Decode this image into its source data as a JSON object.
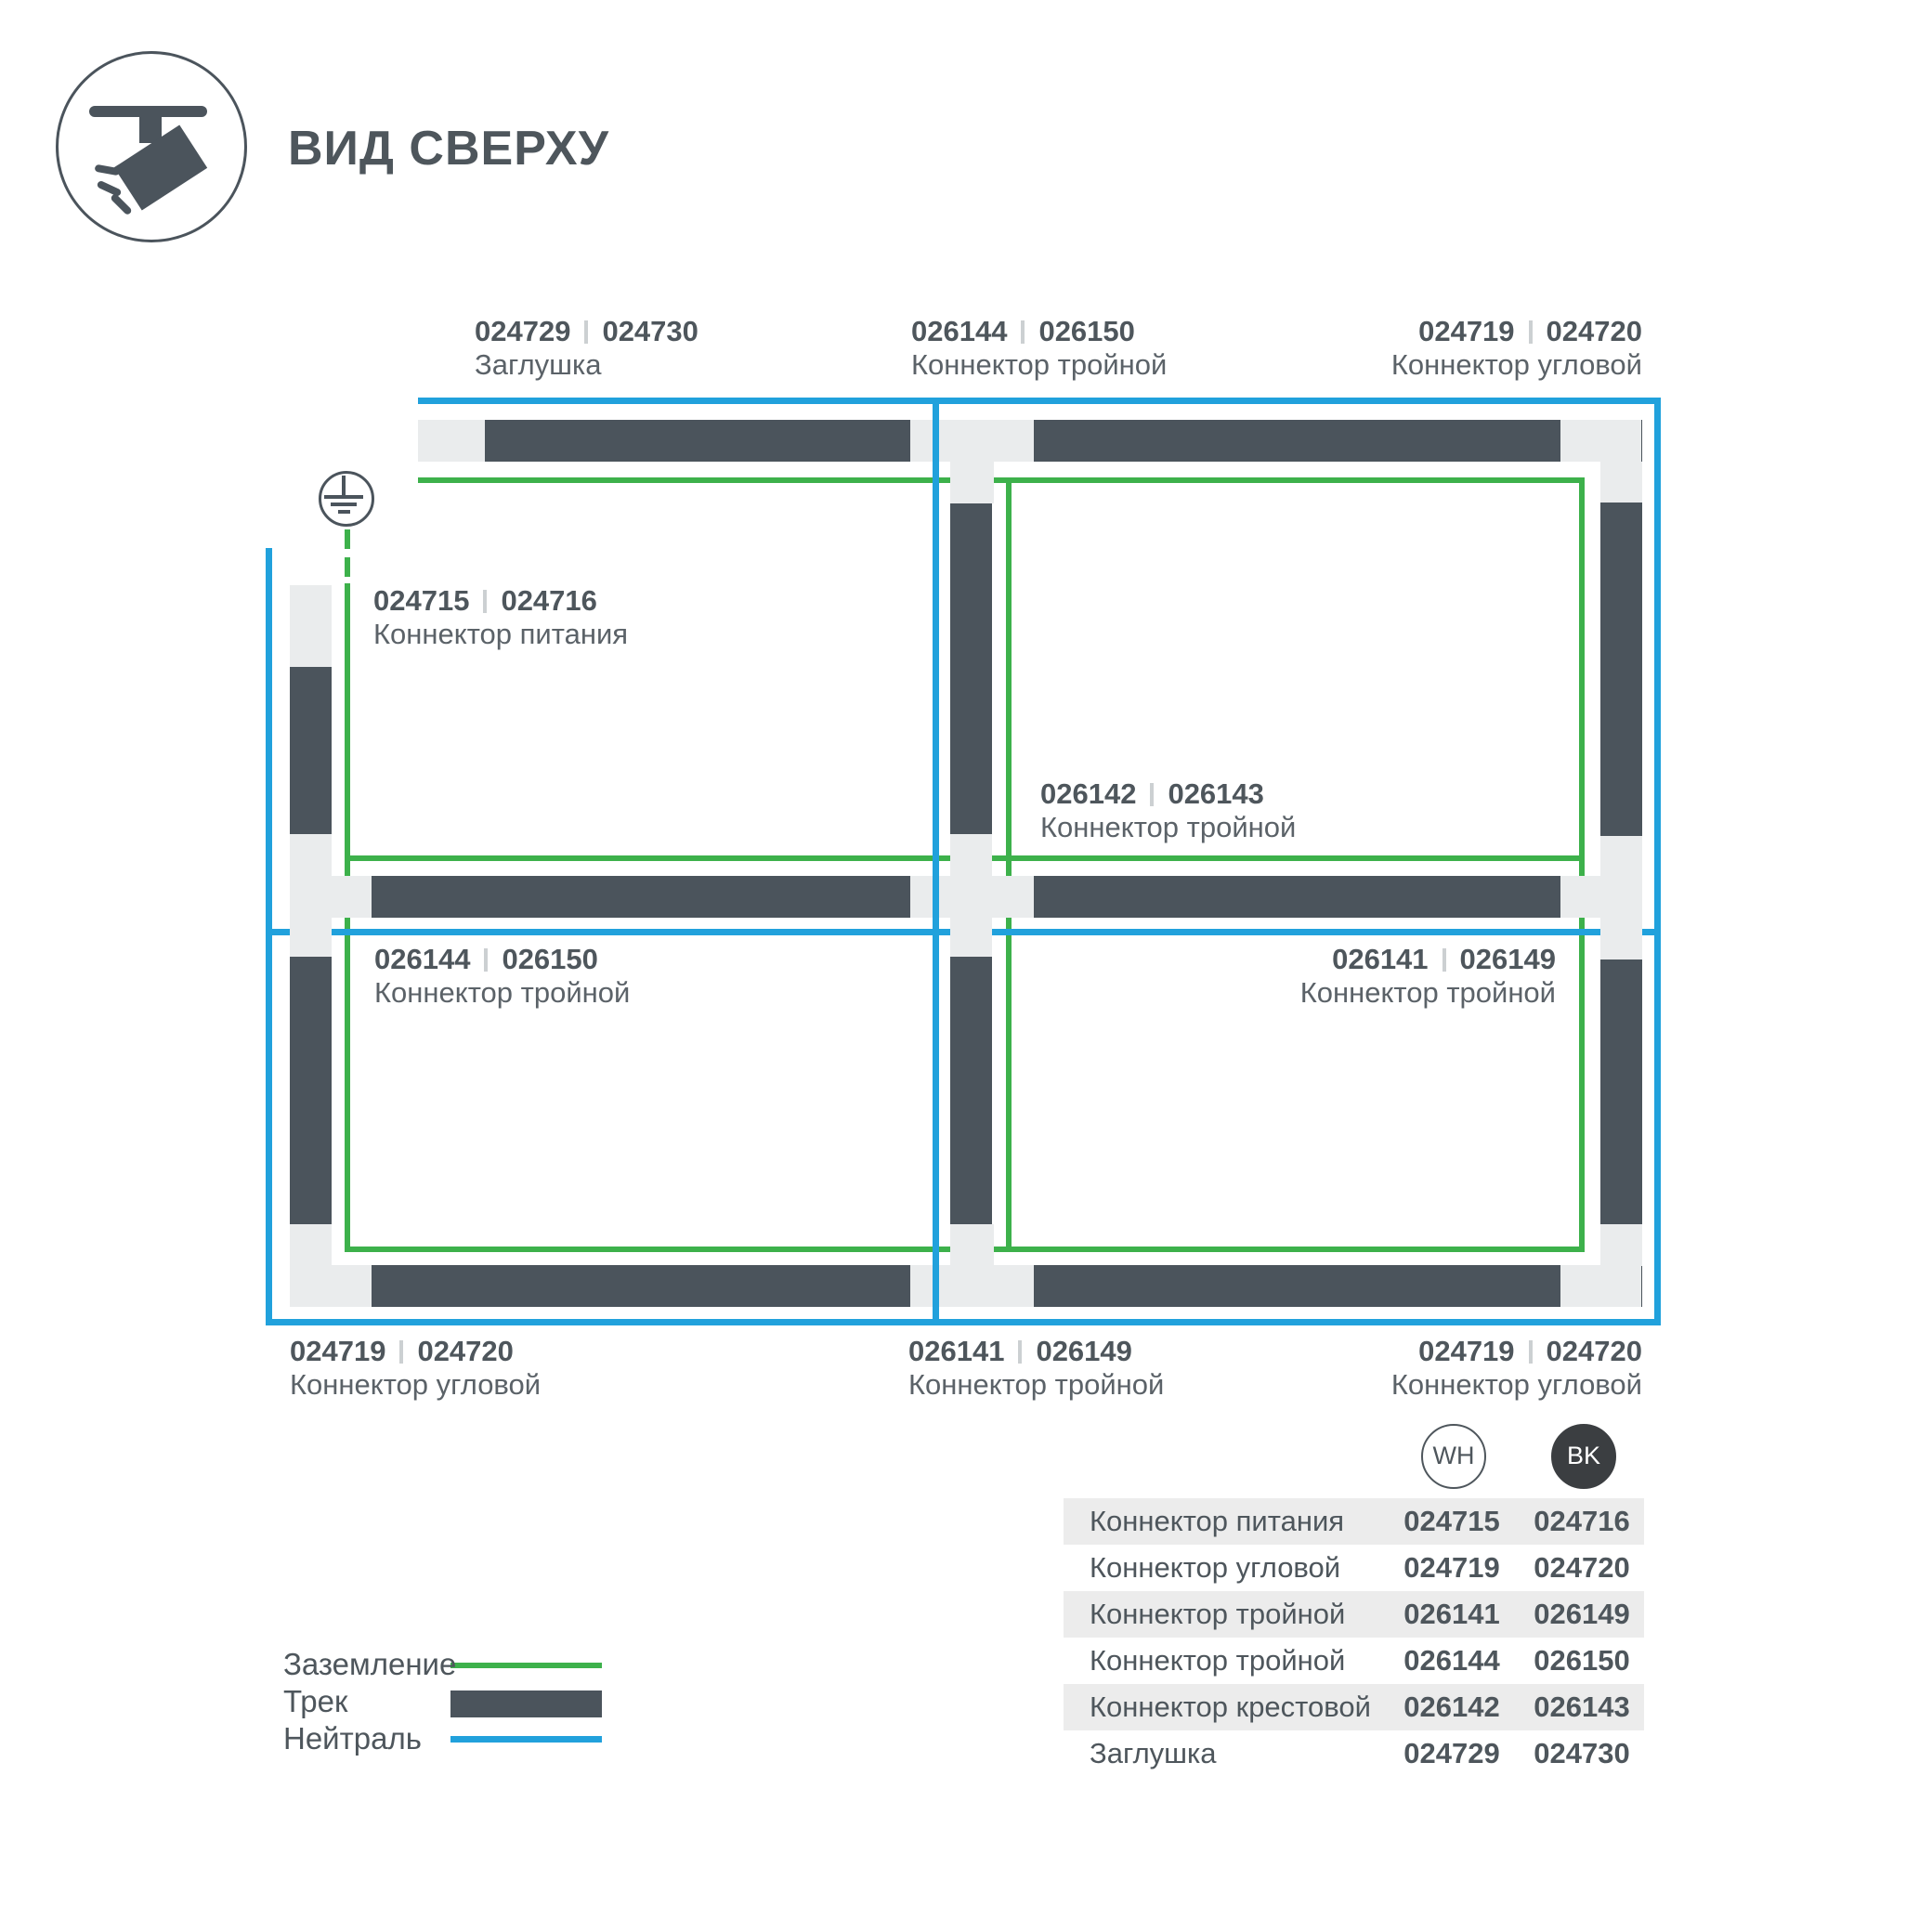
{
  "title": "ВИД СВЕРХУ",
  "colors": {
    "track": "#4b545c",
    "conn": "#eaeced",
    "ground": "#3db14b",
    "neutral": "#21a1dc",
    "text": "#4e565c",
    "textSoft": "#5b6268",
    "shade": "#ececec",
    "sep": "#ccd0d2",
    "bk": "#3b3e41"
  },
  "diagram": {
    "labels": [
      {
        "num1": "024729",
        "num2": "024730",
        "name": "Заглушка"
      },
      {
        "num1": "026144",
        "num2": "026150",
        "name": "Коннектор тройной"
      },
      {
        "num1": "024719",
        "num2": "024720",
        "name": "Коннектор угловой"
      },
      {
        "num1": "024715",
        "num2": "024716",
        "name": "Коннектор питания"
      },
      {
        "num1": "026142",
        "num2": "026143",
        "name": "Коннектор тройной"
      },
      {
        "num1": "026144",
        "num2": "026150",
        "name": "Коннектор тройной"
      },
      {
        "num1": "026141",
        "num2": "026149",
        "name": "Коннектор тройной"
      },
      {
        "num1": "024719",
        "num2": "024720",
        "name": "Коннектор угловой"
      },
      {
        "num1": "026141",
        "num2": "026149",
        "name": "Коннектор тройной"
      },
      {
        "num1": "024719",
        "num2": "024720",
        "name": "Коннектор угловой"
      }
    ]
  },
  "legend": {
    "items": [
      {
        "label": "Заземление",
        "swatch": "ground-line"
      },
      {
        "label": "Трек",
        "swatch": "track-bar"
      },
      {
        "label": "Нейтраль",
        "swatch": "neutral-line"
      }
    ]
  },
  "table": {
    "columns": [
      {
        "label": "WH"
      },
      {
        "label": "BK"
      }
    ],
    "rows": [
      {
        "name": "Коннектор питания",
        "wh": "024715",
        "bk": "024716"
      },
      {
        "name": "Коннектор угловой",
        "wh": "024719",
        "bk": "024720"
      },
      {
        "name": "Коннектор тройной",
        "wh": "026141",
        "bk": "026149"
      },
      {
        "name": "Коннектор тройной",
        "wh": "026144",
        "bk": "026150"
      },
      {
        "name": "Коннектор крестовой",
        "wh": "026142",
        "bk": "026143"
      },
      {
        "name": "Заглушка",
        "wh": "024729",
        "bk": "024730"
      }
    ]
  }
}
